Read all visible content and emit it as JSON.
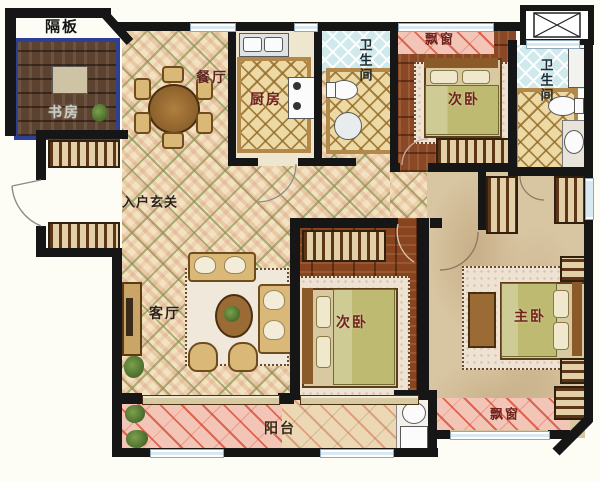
{
  "labels": {
    "partition": "隔板",
    "study": "书房",
    "dining": "餐厅",
    "kitchen": "厨房",
    "bath_top": "卫生间",
    "bath_right": "卫生间",
    "bay_top": "飘窗",
    "bedroom_top": "次卧",
    "foyer": "入户玄关",
    "living": "客厅",
    "bedroom_mid": "次卧",
    "master": "主卧",
    "balcony": "阳台",
    "bay_bottom": "飘窗"
  },
  "colors": {
    "wall": "#161616",
    "label_red": "#72211a",
    "label_dark": "#2a2118",
    "study_frame": "#2e3f96",
    "tile_beige": "#f2e2c0",
    "wood_brown": "#87441f",
    "bath_blue": "#cfe9ec",
    "balcony_pink": "#f2c5b6",
    "marble_tan": "#d8c5a1"
  }
}
